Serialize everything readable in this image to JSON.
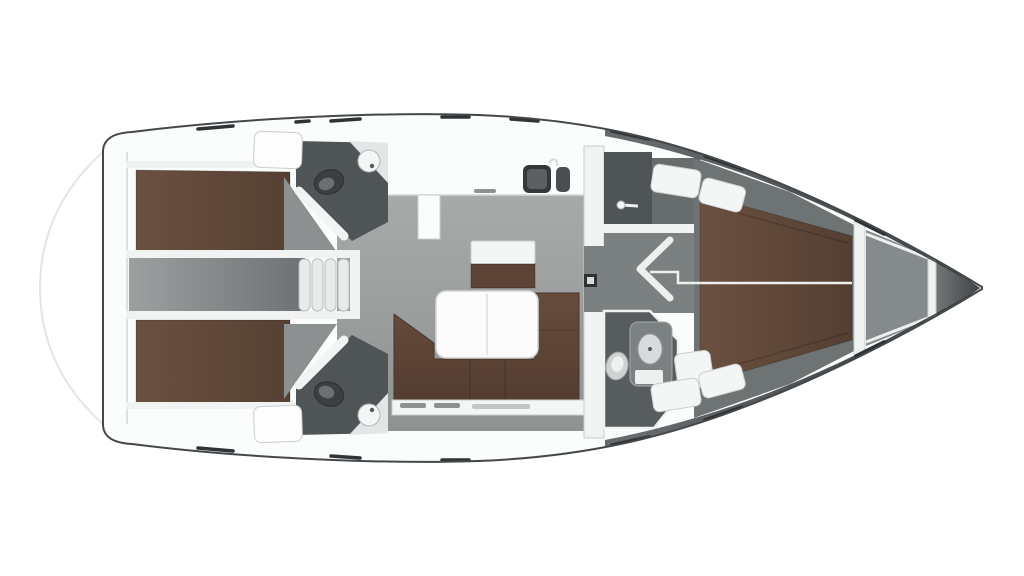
{
  "diagram": {
    "type": "floor-plan",
    "subject": "Sailing yacht interior layout, top-down 3D rendered plan",
    "orientation": {
      "bow": "right",
      "stern": "left",
      "port": "top",
      "starboard": "bottom"
    },
    "rooms": [
      {
        "name": "Swim platform",
        "position": "stern"
      },
      {
        "name": "Aft cabin port",
        "furniture": [
          "double berth"
        ]
      },
      {
        "name": "Aft cabin starboard",
        "furniture": [
          "double berth"
        ]
      },
      {
        "name": "Engine compartment",
        "position": "between aft cabins"
      },
      {
        "name": "Aft head port",
        "furniture": [
          "toilet",
          "corner washbasin"
        ]
      },
      {
        "name": "Aft head starboard",
        "furniture": [
          "toilet",
          "corner washbasin"
        ]
      },
      {
        "name": "Companionway",
        "furniture": [
          "four steps"
        ]
      },
      {
        "name": "Galley",
        "furniture": [
          "counter",
          "double sink",
          "faucet"
        ]
      },
      {
        "name": "Saloon",
        "furniture": [
          "U-shaped settee",
          "table",
          "navigator bench",
          "storage cabinet"
        ]
      },
      {
        "name": "Shower room",
        "furniture": [
          "shower rail"
        ]
      },
      {
        "name": "Forward corridor",
        "furniture": [
          "open chevron door"
        ]
      },
      {
        "name": "Forward head",
        "furniture": [
          "toilet",
          "vanity with washbasin",
          "drawer"
        ]
      },
      {
        "name": "Forward owner cabin",
        "furniture": [
          "V-berth double bed",
          "lockers",
          "seat"
        ]
      },
      {
        "name": "Anchor locker",
        "position": "bow"
      }
    ]
  },
  "colors": {
    "background": "#ffffff",
    "hull_line": "#44484a",
    "deck": "#fbfcfc",
    "wall": "#f1f3f3",
    "wall_stroke": "#cbcece",
    "platform_line": "#e3e5e5",
    "transom_line": "#dfe1e1",
    "floor_light": "#a7aaa9",
    "floor_dark": "#8e9291",
    "corridor_light": "#9ba0a0",
    "corridor_dark": "#6d7173",
    "fwd_floor": "#6e7374",
    "aux_floor": "#676c6d",
    "head_floor": "#4f5456",
    "head_floor2": "#575c5e",
    "wedge_floor": "#8d9091",
    "berth_light": "#6b5040",
    "berth_dark": "#543f32",
    "sofa_light": "#684d3d",
    "sofa_dark": "#533d31",
    "bench_brown": "#5d4335",
    "table": "#fcfcfc",
    "table_stroke": "#d2d5d5",
    "table_line": "#e3e5e5",
    "fixture_dark": "#35393b",
    "fixture_dark2": "#3b3f41",
    "fixture_mid": "#7c8182",
    "fixture_light": "#d8dbdb",
    "fixture_white": "#eef0f0",
    "white_furniture": "#f4f6f6",
    "door": "#f2f3f3",
    "counter_white": "#e3e6e6",
    "step": "#e9ebeb",
    "step_stroke": "#b9bcbd",
    "window_dash": "#2f3335",
    "shade_mid": "#595d5f",
    "shade_dark": "#26292b",
    "anchor": "#858a8c",
    "bow_mid": "#6f7475",
    "bow_tip": "#3c4042",
    "latch": "#2f3234",
    "handle": "#8d9192",
    "corridor_gap": "#7b8081"
  }
}
